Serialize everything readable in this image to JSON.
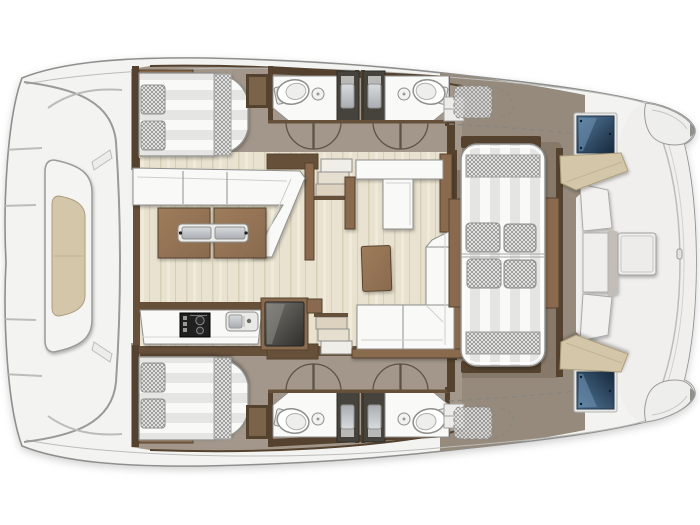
{
  "meta": {
    "type": "yacht-floor-plan",
    "vessel": "catamaran",
    "view": "top-down",
    "background": "#ffffff"
  },
  "palette": {
    "deck": "#f3f3f1",
    "outline": "#8e8e8c",
    "hullfloor": "#a2978a",
    "salonfloor": "#e9e2d0",
    "grainA": "#d9cfb6",
    "grainB": "#f0ead9",
    "cockpitfloor": "#968a7c",
    "cockpitpatch": "#87796a",
    "wood": "#8a6a4e",
    "woodlight": "#9d7c5b",
    "wooddark": "#54422e",
    "wallbrown": "#66503a",
    "furnwhite": "#f9f9f8",
    "furnstroke": "#8f8f8d",
    "stripe": "#e5e5e3",
    "checkbg": "#f1f1f0",
    "checkline": "#909090",
    "beige": "#d4c6a8",
    "beigestroke": "#ab9c7c",
    "showerdark": "#46433c",
    "glasslight": "#54789a",
    "glassdeep": "#16293c",
    "glasshi": "#7b9cba",
    "stove": "#202020",
    "steelA": "#d8dbde",
    "steelB": "#a9adb2",
    "applA": "#77756f",
    "applB": "#2f2e2b",
    "platform": "#f0efed",
    "seam": "#bcbcba",
    "dash": "#86867f",
    "arc": "#5f5244"
  },
  "areas": [
    {
      "id": "bow-deck",
      "label": "bow deck with sun lounger"
    },
    {
      "id": "upper-hull-cabin",
      "label": "double cabin, island bed, 2 pillows"
    },
    {
      "id": "upper-hull-bathrooms",
      "label": "two bathrooms with shower stalls"
    },
    {
      "id": "lower-hull-cabin",
      "label": "double cabin, island bed, 2 pillows"
    },
    {
      "id": "lower-hull-bathrooms",
      "label": "two bathrooms with shower stalls"
    },
    {
      "id": "salon",
      "label": "salon with dinette, split table, nav seat, L-sofa"
    },
    {
      "id": "galley",
      "label": "galley with stove, sink, fridge"
    },
    {
      "id": "cockpit",
      "label": "cockpit with double chaise lounger, 4 pillows"
    },
    {
      "id": "aft-platform",
      "label": "transom platform with bench, glass hatches, hull pods"
    }
  ],
  "inventory": {
    "double_beds": 2,
    "bed_pillows": 4,
    "cockpit_pillows": 4,
    "toilets": 4,
    "bathroom_sinks": 4,
    "shower_stalls": 4,
    "staircases": 2,
    "dining_table_halves": 2,
    "coffee_tables": 1,
    "stoves": 1,
    "galley_sinks": 1,
    "fridges": 1,
    "sun_loungers": 2,
    "glass_hatches": 2,
    "hull_pods": 2,
    "dashed_storage_lockers": 2
  }
}
